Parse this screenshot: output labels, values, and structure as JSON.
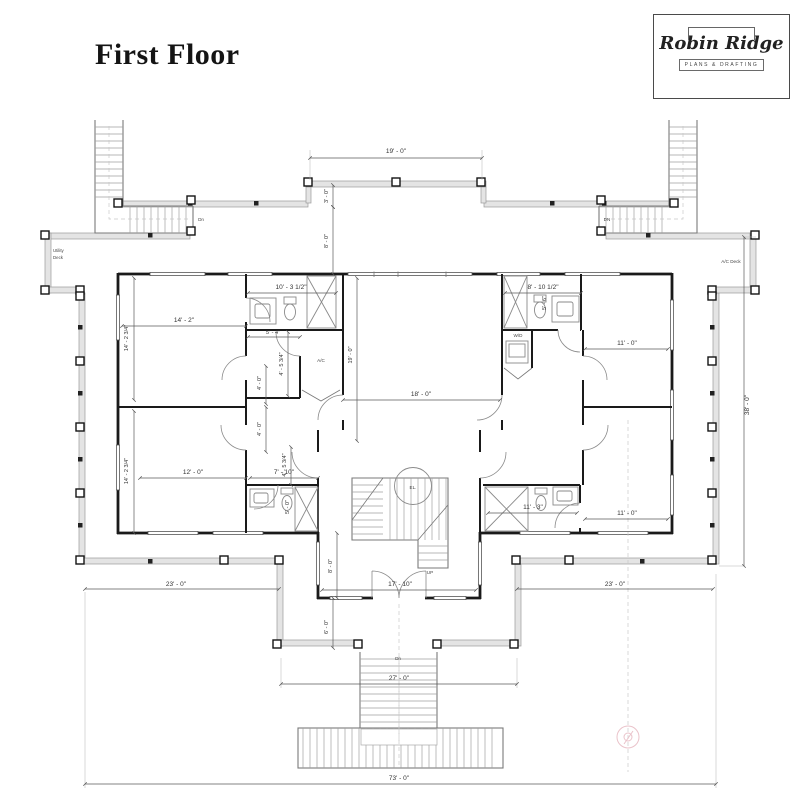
{
  "title": "First Floor",
  "logo": {
    "brand": "Robin Ridge",
    "tagline": "PLANS & DRAFTING"
  },
  "colors": {
    "wall": "#1a1a1a",
    "dim_text": "#333333",
    "porch_band": "#e4e4e4",
    "accent_pink": "#eac3ca"
  },
  "plan": {
    "labels": {
      "utility_deck_line1": "Utility",
      "utility_deck_line2": "Deck",
      "ac_deck": "A/C Deck",
      "ac_closet": "A/C",
      "wd_closet": "W/D",
      "elevator": "EL.",
      "stair_up": "UP",
      "stair_down_left": "Dn",
      "stair_down_right": "DN",
      "stair_down_front": "Dn"
    },
    "dims": {
      "deck_width": "19' - 0\"",
      "deck_rail_depth": "3' - 0\"",
      "north_porch_depth": "8' - 0\"",
      "bath_tl_width": "10' - 3 1/2\"",
      "bath_tr_width": "8' - 10 1/2\"",
      "bath_tr_depth": "5' - 6\"",
      "bed_tl_width": "14' - 2\"",
      "bed_tl_depth": "14' - 2 3/4\"",
      "closet_tl_width": "5' - 4\"",
      "closet_tl_depth": "4' - 5 3/4\"",
      "bed_tr_width": "11' - 0\"",
      "great_width": "18' - 0\"",
      "great_depth": "19' - 0\"",
      "hall_upper": "4' - 0\"",
      "hall_lower": "4' - 0\"",
      "bed_bl_width": "12' - 0\"",
      "bed_bl_depth": "14' - 2 3/4\"",
      "hall_bl_width": "7' - 10\"",
      "hall_bl_depth": "4' - 5 3/4\"",
      "bath_bl_depth": "5' - 0\"",
      "bath_br_width": "11' - 3\"",
      "bed_br_width": "11' - 0\"",
      "entry_width": "17' - 10\"",
      "entry_depth": "8' - 0\"",
      "entry_porch_depth": "6' - 0\"",
      "porch_left": "23' - 0\"",
      "porch_right": "23' - 0\"",
      "steps_width": "27' - 0\"",
      "overall_width": "73' - 0\"",
      "overall_depth": "38' - 0\""
    }
  }
}
